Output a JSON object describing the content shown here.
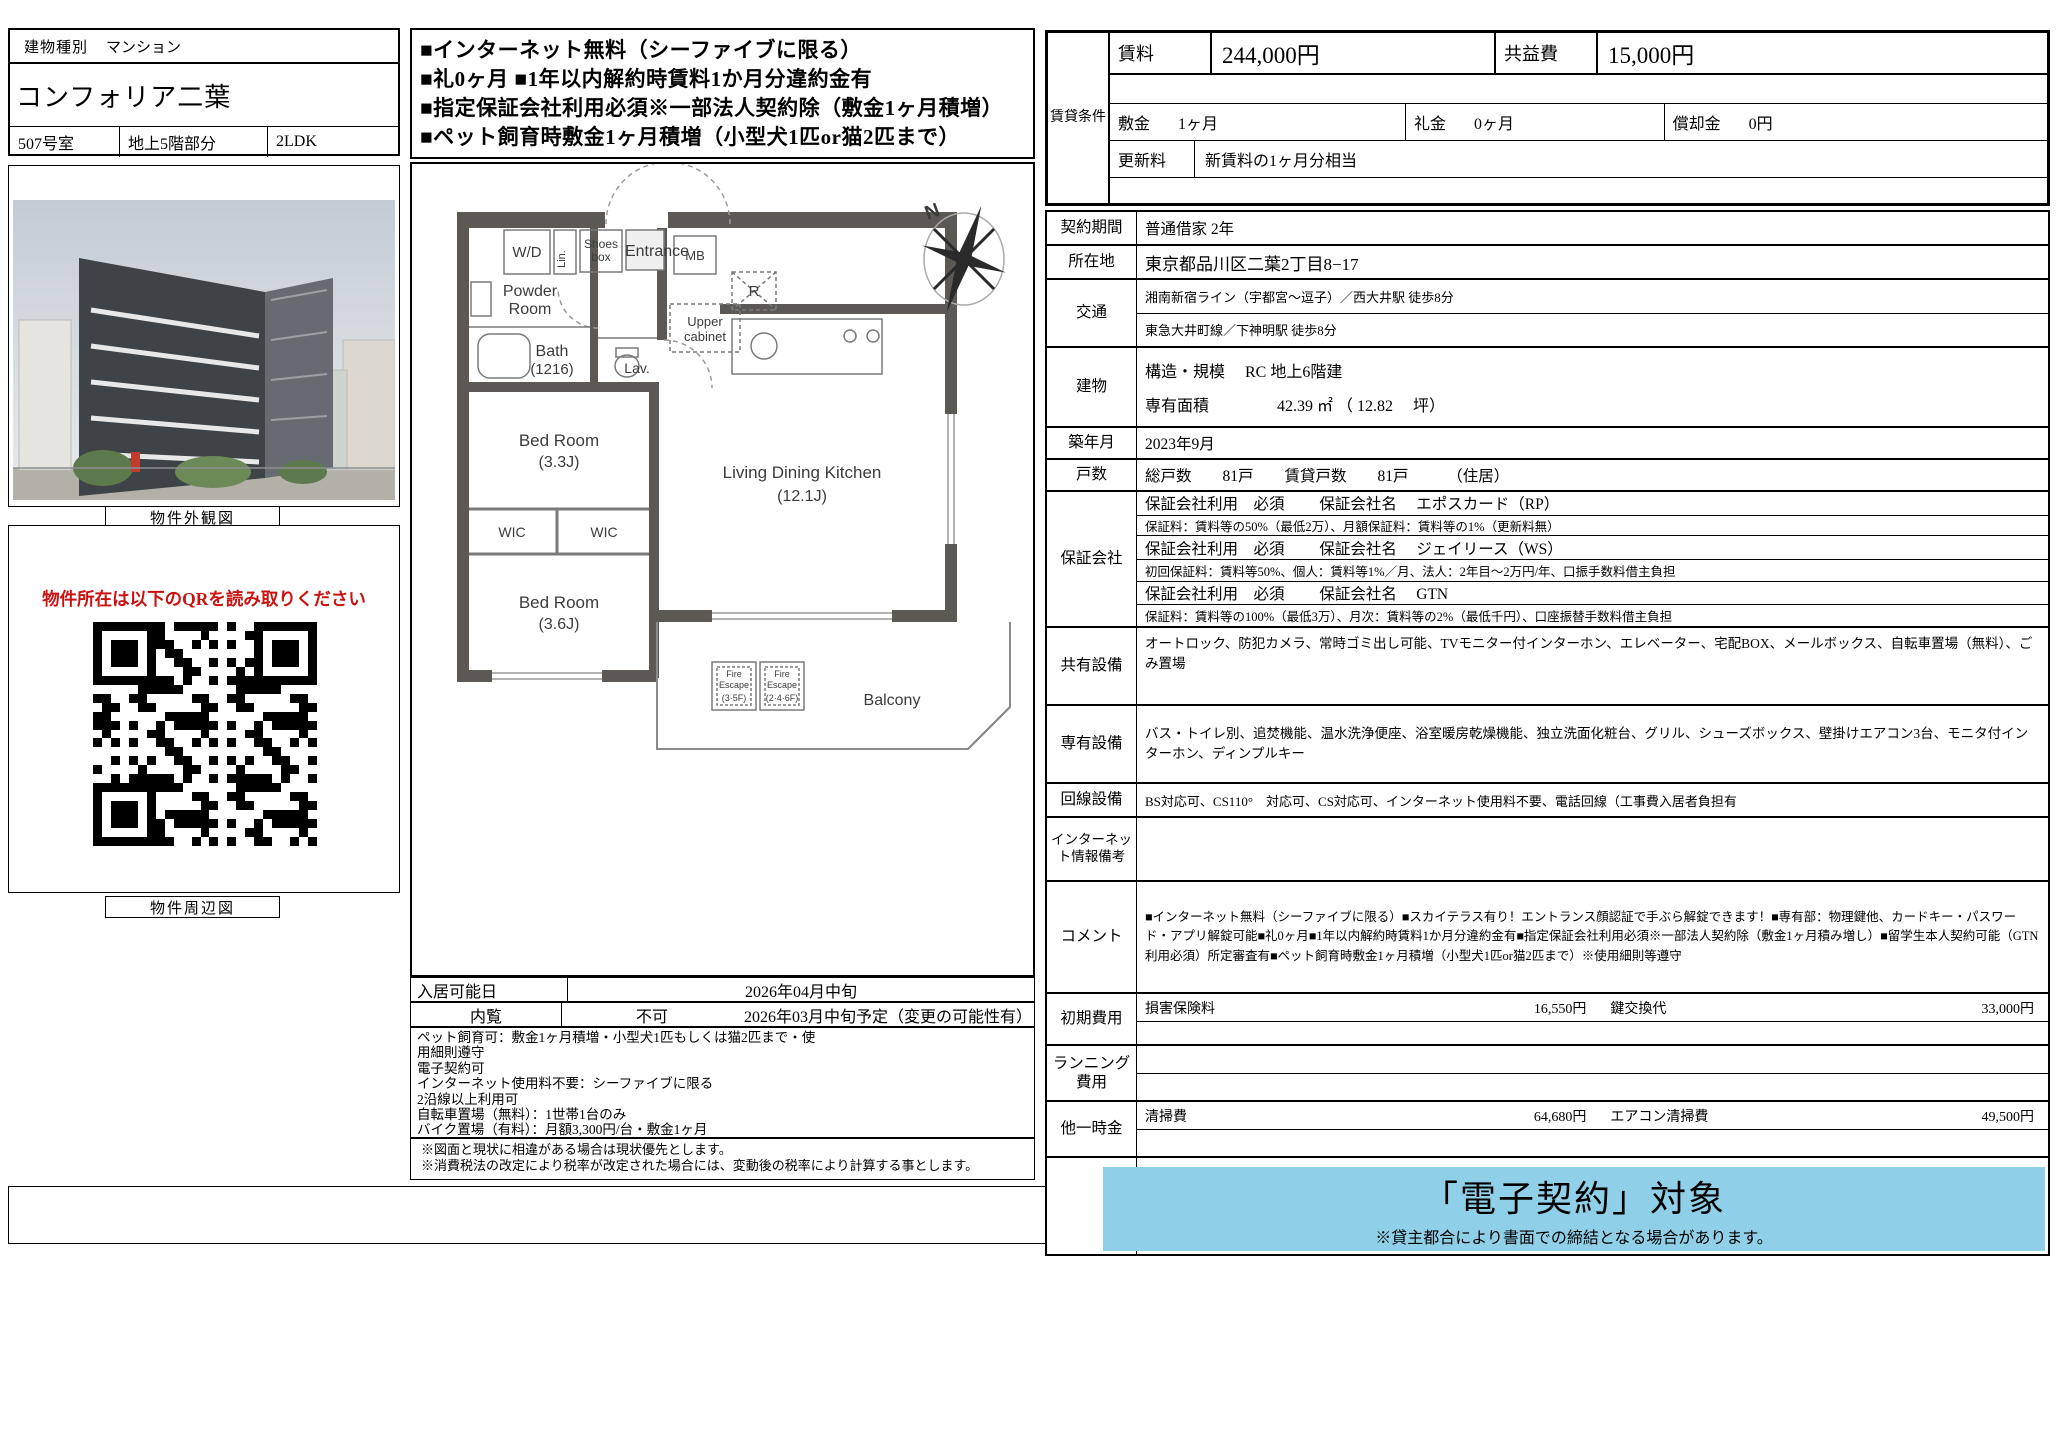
{
  "header_left": {
    "building_type_label": "建物種別",
    "building_type_value": "マンション",
    "building_name": "コンフォリア二葉",
    "room_no": "507号室",
    "floor": "地上5階部分",
    "layout": "2LDK"
  },
  "highlights": {
    "lines": [
      "■インターネット無料（シーファイブに限る）",
      "■礼0ヶ月 ■1年以内解約時賃料1か月分違約金有",
      "■指定保証会社利用必須※一部法人契約除（敷金1ヶ月積増）",
      "■ペット飼育時敷金1ヶ月積増（小型犬1匹or猫2匹まで）"
    ]
  },
  "photo": {
    "caption": "物件外観図"
  },
  "qr": {
    "notice": "物件所在は以下のQRを読み取りください",
    "caption": "物件周辺図"
  },
  "floorplan": {
    "compass_n": "N",
    "labels": {
      "wd": "W/D",
      "lin": "Lin.",
      "shoes1": "Shoes",
      "shoes2": "box",
      "entrance": "Entrance",
      "mb": "MB",
      "r": "R",
      "powder1": "Powder",
      "powder2": "Room",
      "upper1": "Upper",
      "upper2": "cabinet",
      "bath1": "Bath",
      "bath2": "(1216)",
      "lav": "Lav.",
      "bed1_1": "Bed Room",
      "bed1_2": "(3.3J)",
      "wic_left": "WIC",
      "wic_right": "WIC",
      "bed2_1": "Bed Room",
      "bed2_2": "(3.6J)",
      "ldk1": "Living Dining Kitchen",
      "ldk2": "(12.1J)",
      "fe1_1": "Fire",
      "fe1_2": "Escape",
      "fe1_3": "(3·5F)",
      "fe2_1": "Fire",
      "fe2_2": "Escape",
      "fe2_3": "(2·4·6F)",
      "balcony": "Balcony"
    }
  },
  "move_in": {
    "label": "入居可能日",
    "value": "2026年04月中旬",
    "viewing_label": "内覧",
    "viewing_value": "不可",
    "viewing_note": "2026年03月中旬予定（変更の可能性有）"
  },
  "conditions_lines": [
    "ペット飼育可：敷金1ヶ月積増・小型犬1匹もしくは猫2匹まで・使",
    "用細則遵守",
    "電子契約可",
    "インターネット使用料不要：シーファイブに限る",
    "2沿線以上利用可",
    "自転車置場（無料）：1世帯1台のみ",
    "バイク置場（有料）：月額3,300円/台・敷金1ヶ月"
  ],
  "notes": [
    "※図面と現状に相違がある場合は現状優先とします。",
    "※消費税法の改定により税率が改定された場合には、変動後の税率により計算する事とします。"
  ],
  "rent_table": {
    "group_label": "賃貸条件",
    "rent_label": "賃料",
    "rent_value": "244,000円",
    "fee_label": "共益費",
    "fee_value": "15,000円",
    "deposit_label": "敷金",
    "deposit_value": "1ヶ月",
    "key_money_label": "礼金",
    "key_money_value": "0ヶ月",
    "amortization_label": "償却金",
    "amortization_value": "0円",
    "renewal_label": "更新料",
    "renewal_value": "新賃料の1ヶ月分相当"
  },
  "details": {
    "contract": {
      "label": "契約期間",
      "value": "普通借家 2年"
    },
    "location": {
      "label": "所在地",
      "value": "東京都品川区二葉2丁目8−17"
    },
    "access": {
      "label": "交通",
      "line1": "湘南新宿ライン（宇都宮～逗子）／西大井駅 徒歩8分",
      "line2": "東急大井町線／下神明駅 徒歩8分"
    },
    "building": {
      "label": "建物",
      "structure": "構造・規模　 RC 地上6階建",
      "area": "専有面積　　　　 42.39 ㎡ （ 12.82　 坪）"
    },
    "built": {
      "label": "築年月",
      "value": "2023年9月"
    },
    "units": {
      "label": "戸数",
      "value": "総戸数　　81戸　　賃貸戸数　　81戸　　　（住居）"
    },
    "guarantor": {
      "label": "保証会社",
      "rows": [
        "保証会社利用　必須　　 保証会社名　 エポスカード（RP）",
        "保証料：賃料等の50%（最低2万）、月額保証料：賃料等の1%（更新料無）",
        "保証会社利用　必須　　 保証会社名　 ジェイリース（WS）",
        "初回保証料：賃料等50%、個人：賃料等1%／月、法人：2年目～2万円/年、口振手数料借主負担",
        "保証会社利用　必須　　 保証会社名　 GTN",
        "保証料：賃料等の100%（最低3万）、月次：賃料等の2%（最低千円）、口座振替手数料借主負担"
      ]
    },
    "shared": {
      "label": "共有設備",
      "value": "オートロック、防犯カメラ、常時ゴミ出し可能、TVモニター付インターホン、エレベーター、宅配BOX、メールボックス、自転車置場（無料）、ごみ置場"
    },
    "private": {
      "label": "専有設備",
      "value": "バス・トイレ別、追焚機能、温水洗浄便座、浴室暖房乾燥機能、独立洗面化粧台、グリル、シューズボックス、壁掛けエアコン3台、モニタ付インターホン、ディンプルキー"
    },
    "line_equipment": {
      "label": "回線設備",
      "value": "BS対応可、CS110°　対応可、CS対応可、インターネット使用料不要、電話回線（工事費入居者負担有"
    },
    "internet_note": {
      "label": "インターネット情報備考",
      "value": ""
    },
    "comment": {
      "label": "コメント",
      "value": "■インターネット無料（シーファイブに限る）■スカイテラス有り！エントランス顔認証で手ぶら解錠できます！■専有部：物理鍵他、カードキー・パスワード・アプリ解錠可能■礼0ヶ月■1年以内解約時賃料1か月分違約金有■指定保証会社利用必須※一部法人契約除（敷金1ヶ月積み増し）■留学生本人契約可能（GTN利用必須）所定審査有■ペット飼育時敷金1ヶ月積増（小型犬1匹or猫2匹まで）※使用細則等遵守"
    },
    "initial_cost": {
      "label": "初期費用",
      "item1_label": "損害保険料",
      "item1_value": "16,550円",
      "item2_label": "鍵交換代",
      "item2_value": "33,000円"
    },
    "running_cost": {
      "label": "ランニング費用"
    },
    "other_cost": {
      "label": "他一時金",
      "item1_label": "清掃費",
      "item1_value": "64,680円",
      "item2_label": "エアコン清掃費",
      "item2_value": "49,500円"
    },
    "e_contract": {
      "title": "「電子契約」対象",
      "note": "※貸主都合により書面での締結となる場合があります。",
      "bg_color": "#8fd0e8"
    }
  }
}
